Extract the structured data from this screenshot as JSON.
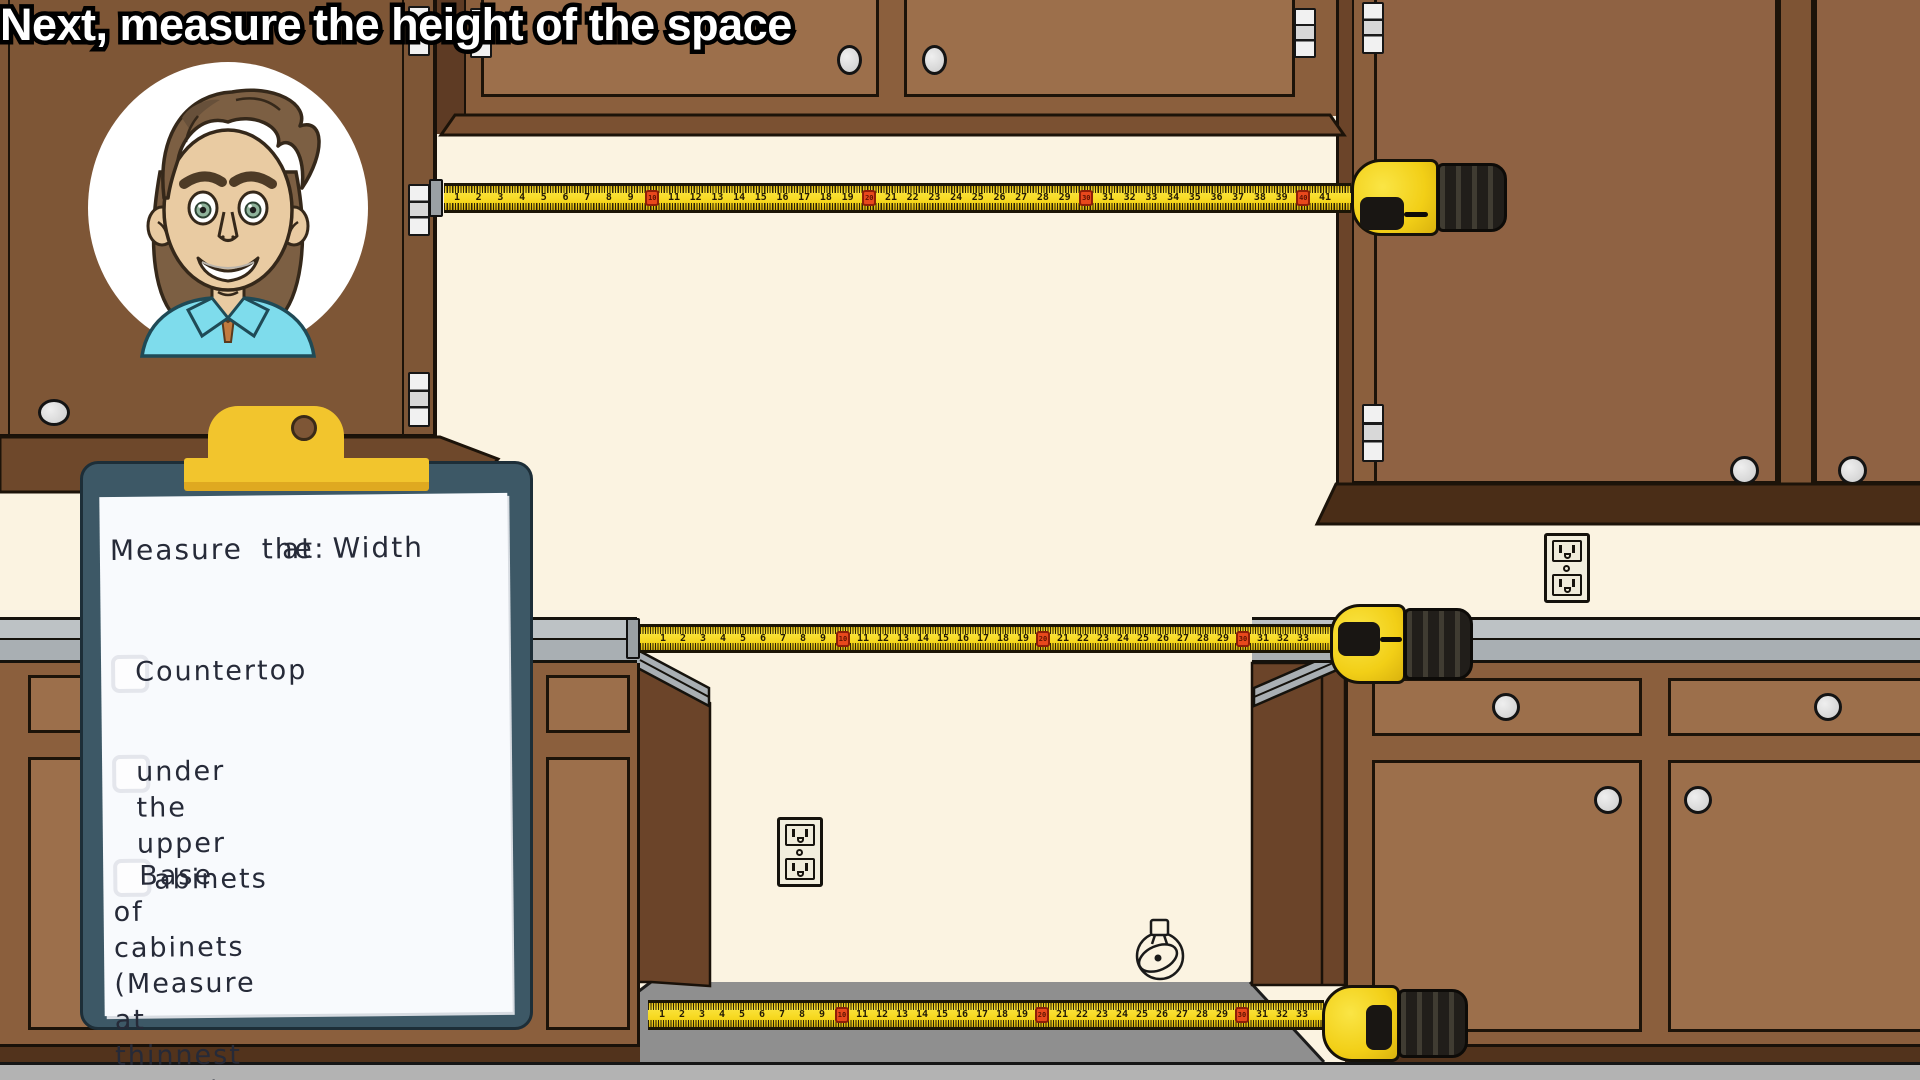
{
  "caption": {
    "text": "Next, measure the height of the space"
  },
  "clipboard": {
    "heading_line1": "Measure the Width",
    "heading_line2": "at:",
    "items": [
      {
        "label": "Countertop",
        "checked": false,
        "indent": false
      },
      {
        "label": "under the upper\ncabinets",
        "checked": false,
        "indent": false
      },
      {
        "label": "Base of cabinets\n(Measure at\nthinnest points)",
        "checked": false,
        "indent": true
      }
    ]
  },
  "tapes": [
    {
      "id": "upper-width-tape",
      "first_number": 1,
      "last_number": 41,
      "highlight_every": 10
    },
    {
      "id": "counter-width-tape",
      "first_number": 1,
      "last_number": 33,
      "highlight_every": 10
    },
    {
      "id": "base-width-tape",
      "first_number": 1,
      "last_number": 33,
      "highlight_every": 10
    }
  ],
  "colors": {
    "wall": "#FBF3E1",
    "cabinet_face": "#8B5F3D",
    "cabinet_door": "#9C6F4B",
    "cabinet_dark": "#6B4429",
    "countertop": "#BDC2C5",
    "floor": "#B3B3B3",
    "alcove_shadow": "#8F8F8F",
    "tape_yellow": "#F6D71C",
    "tape_red": "#E8481C",
    "clipboard_board": "#3D5866",
    "clip_gold": "#F2C52D",
    "shirt_blue": "#7EDCEC"
  }
}
